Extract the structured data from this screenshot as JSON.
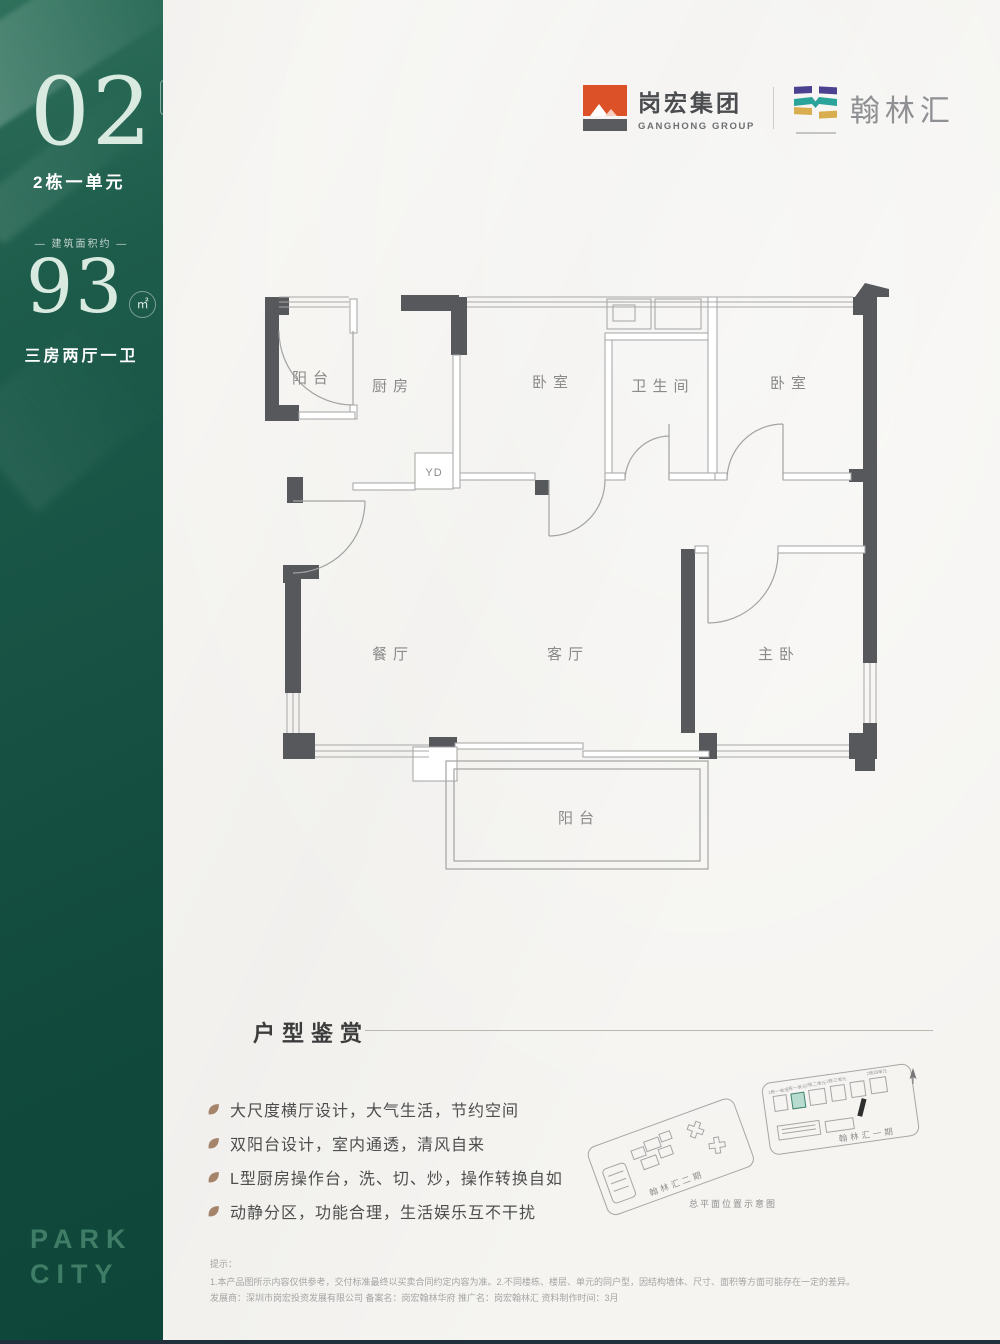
{
  "sidebar": {
    "unit_number": "02",
    "unit_badge": "户型",
    "unit_label": "2栋一单元",
    "area_caption": "— 建筑面积约 —",
    "area_value": "93",
    "area_unit": "㎡",
    "layout_label": "三房两厅一卫",
    "brand_line1": "PARK",
    "brand_line2": "CITY"
  },
  "header": {
    "ganghong_name": "岗宏集团",
    "ganghong_sub": "GANGHONG GROUP",
    "hanlin_name": "翰林汇"
  },
  "floor_plan": {
    "rooms": {
      "balcony_top": "阳台",
      "kitchen": "厨房",
      "bedroom_mid": "卧室",
      "bathroom": "卫生间",
      "bedroom_right": "卧室",
      "dining": "餐厅",
      "living": "客厅",
      "master": "主卧",
      "balcony_bottom": "阳台"
    },
    "shaft": "YD"
  },
  "features": {
    "title": "户型鉴赏",
    "items": [
      "大尺度横厅设计，大气生活，节约空间",
      "双阳台设计，室内通透，清风自来",
      "L型厨房操作台，洗、切、炒，操作转换自如",
      "动静分区，功能合理，生活娱乐互不干扰"
    ]
  },
  "site_plan": {
    "phase2_label": "翰林汇二期",
    "phase1_label": "翰林汇一期",
    "caption": "总平面位置示意图",
    "buildings": [
      "1栋一单元",
      "2栋一单元",
      "2栋二单元",
      "2栋三单元",
      "2栋四单元"
    ]
  },
  "disclaimer": {
    "tip": "提示：",
    "line1": "1.本产品图所示内容仅供参考，交付标准最终以买卖合同约定内容为准。2.不同楼栋、楼层、单元的同户型，因结构墙体、尺寸、面积等方面可能存在一定的差异。",
    "line2": "发展商：深圳市岗宏投资发展有限公司  备案名：岗宏翰林华府  推广名：岗宏翰林汇  资料制作时间：3月"
  },
  "colors": {
    "sidebar_green": "#175244",
    "mint_text": "#d9eae1",
    "brand_green": "#3f7d66",
    "wall_gray": "#57585c",
    "logo_orange": "#dd5128",
    "logo_purple": "#4a4191",
    "logo_teal": "#2aa39a",
    "logo_yellow": "#d9ae4e",
    "highlight_teal": "#b9dcd0"
  }
}
